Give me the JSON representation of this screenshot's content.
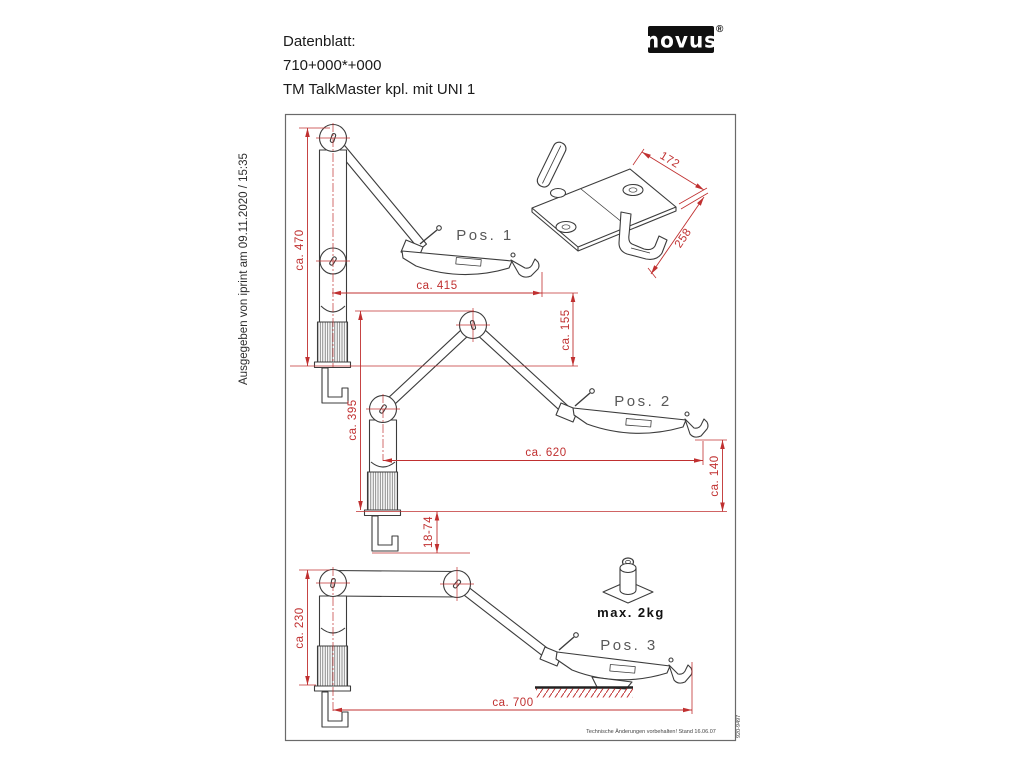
{
  "header": {
    "line1": "Datenblatt:",
    "line2": "710+000*+000",
    "line3": "TM TalkMaster kpl. mit UNI 1"
  },
  "logo": {
    "text": "novus",
    "registered": "®"
  },
  "side_note": "Ausgegeben von iprint am 09.11.2020 / 15:35",
  "drawing": {
    "positions": [
      "Pos. 1",
      "Pos. 2",
      "Pos. 3"
    ],
    "dims": {
      "pos1_height": "ca. 470",
      "pos1_reach": "ca. 415",
      "pos1_tray_height": "ca. 155",
      "pos2_height": "ca. 395",
      "pos2_reach": "ca. 620",
      "pos2_tray_height": "ca. 140",
      "clamp_range": "18-74",
      "pos3_height": "ca. 230",
      "pos3_reach": "ca. 700",
      "plate_width": "172",
      "plate_depth": "258"
    },
    "max_load": "max. 2kg",
    "footer_note": "Technische Änderungen vorbehalten! Stand 16.06.07",
    "doc_number": "920-9497"
  },
  "colors": {
    "dimension": "#c03030",
    "line": "#3c3c3c",
    "label": "#585858"
  }
}
